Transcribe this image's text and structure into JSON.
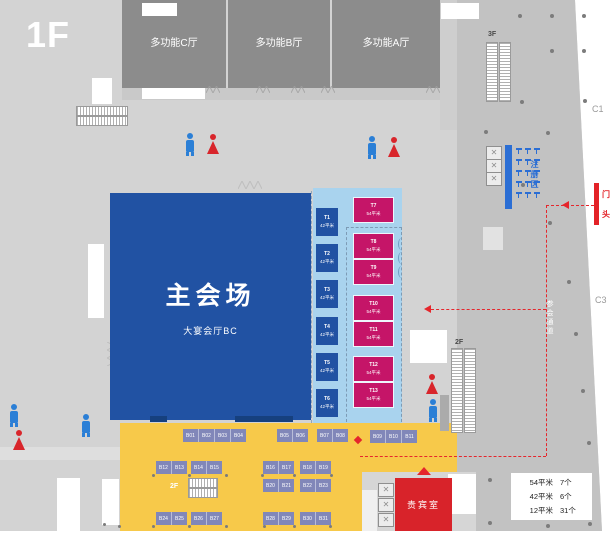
{
  "floor_label": "1F",
  "halls": {
    "c": "多功能C厅",
    "b": "多功能B厅",
    "a": "多功能A厅"
  },
  "main_venue": {
    "title": "主会场",
    "subtitle": "大宴会厅BC"
  },
  "booths": {
    "t_blue": [
      {
        "id": "T1",
        "area": "42平米"
      },
      {
        "id": "T2",
        "area": "42平米"
      },
      {
        "id": "T3",
        "area": "42平米"
      },
      {
        "id": "T4",
        "area": "42平米"
      },
      {
        "id": "T5",
        "area": "42平米"
      },
      {
        "id": "T6",
        "area": "42平米"
      }
    ],
    "t_pink": [
      {
        "id": "T7",
        "area": "54平米"
      },
      {
        "id": "T8",
        "area": "54平米"
      },
      {
        "id": "T9",
        "area": "54平米"
      },
      {
        "id": "T10",
        "area": "54平米"
      },
      {
        "id": "T11",
        "area": "54平米"
      },
      {
        "id": "T12",
        "area": "54平米"
      },
      {
        "id": "T13",
        "area": "54平米"
      }
    ],
    "b_groups": {
      "row1a": [
        "B01",
        "B02",
        "B03",
        "B04"
      ],
      "row1b": [
        "B05",
        "B06"
      ],
      "row1c": [
        "B07",
        "B08"
      ],
      "row1d": [
        "B09",
        "B10",
        "B11"
      ],
      "row2a": [
        "B12",
        "B13"
      ],
      "row2b": [
        "B14",
        "B15"
      ],
      "row2c": [
        "B16",
        "B17"
      ],
      "row2d": [
        "B18",
        "B19"
      ],
      "row2e": [
        "B20",
        "B21"
      ],
      "row2f": [
        "B22",
        "B23"
      ],
      "row3a": [
        "B24",
        "B25"
      ],
      "row3b": [
        "B26",
        "B27"
      ],
      "row3c": [
        "B28",
        "B29"
      ],
      "row3d": [
        "B30",
        "B31"
      ]
    }
  },
  "vip_room": "贵宾室",
  "registration_label": "注册区",
  "corridor_label": "参会通道",
  "entrance": {
    "char1": "门",
    "char2": "头"
  },
  "escalator_labels": {
    "top_right": "3F",
    "right": "2F",
    "center": "2F"
  },
  "grid_labels": {
    "c1": "C1",
    "c3": "C3"
  },
  "legend": {
    "rows": [
      {
        "size": "54平米",
        "count": "7个"
      },
      {
        "size": "42平米",
        "count": "6个"
      },
      {
        "size": "12平米",
        "count": "31个"
      }
    ]
  },
  "colors": {
    "main_blue": "#2152a3",
    "light_blue": "#a9d3ee",
    "pink": "#c51568",
    "yellow": "#f7c94a",
    "booth_purple": "#8187b9",
    "vip_red": "#d8232a",
    "route_red": "#e5262c",
    "registration_blue": "#2b6ed4"
  }
}
